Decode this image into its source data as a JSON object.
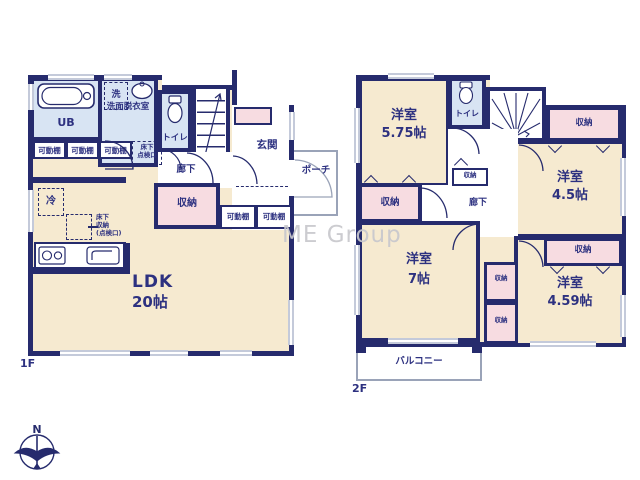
{
  "watermark": "ME Group",
  "compass": {
    "north": "N"
  },
  "palette": {
    "wall": "#262b6d",
    "room_fill": "#f6ead0",
    "wet_fill": "#d8e4f3",
    "closet_fill": "#f7dce1",
    "text": "#2d3180",
    "window": "#c4cada",
    "watermark_color": "#c8c8cd"
  },
  "floor1": {
    "floor_label": "1F",
    "ldk_name": "LDK",
    "ldk_size": "20帖",
    "bath": "UB",
    "laundry": "洗",
    "washroom": "洗面脱衣室",
    "toilet": "トイレ",
    "stairs": "UP",
    "hallway": "廊下",
    "entrance": "玄関",
    "porch": "ポーチ",
    "storage": "収納",
    "shelf": "可動棚",
    "fridge": "冷",
    "underfloor_hatch": "床下\n点検口",
    "underfloor_storage": "床下\n収納\n(点検口)"
  },
  "floor2": {
    "floor_label": "2F",
    "rooms": [
      {
        "name": "洋室",
        "size": "5.75帖"
      },
      {
        "name": "洋室",
        "size": "4.5帖"
      },
      {
        "name": "洋室",
        "size": "7帖"
      },
      {
        "name": "洋室",
        "size": "4.59帖"
      }
    ],
    "toilet": "トイレ",
    "stairs": "DN",
    "hallway": "廊下",
    "storage": "収納",
    "balcony": "バルコニー"
  }
}
